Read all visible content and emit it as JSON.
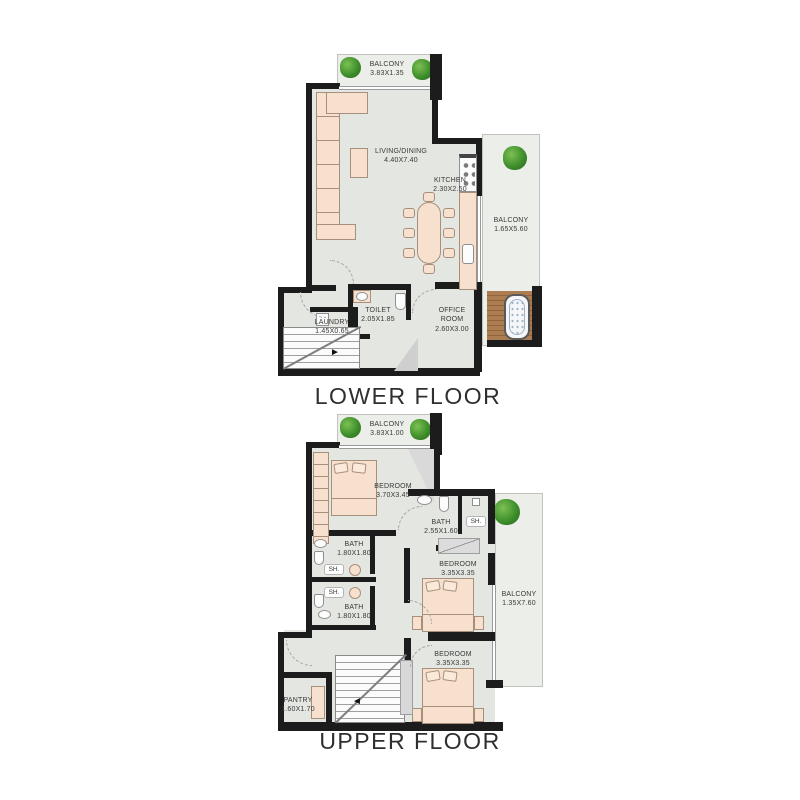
{
  "page": {
    "background": "#ffffff"
  },
  "colors": {
    "wall": "#1c1c1c",
    "floor": "#e4e6e1",
    "balcony_floor": "#eceee9",
    "furniture": "#f7e0cd",
    "wood_deck": "#ab7d50",
    "plant": "#3f8f2c"
  },
  "floors": [
    {
      "title": "LOWER FLOOR",
      "rooms": {
        "balcony_top": {
          "name": "BALCONY",
          "dims": "3.83X1.35"
        },
        "living": {
          "name": "LIVING/DINING",
          "dims": "4.40X7.40"
        },
        "kitchen": {
          "name": "KITCHEN",
          "dims": "2.30X2.50"
        },
        "balcony_right": {
          "name": "BALCONY",
          "dims": "1.65X5.60"
        },
        "toilet": {
          "name": "TOILET",
          "dims": "2.05X1.85"
        },
        "laundry": {
          "name": "LAUNDRY",
          "dims": "1.45X0.65"
        },
        "office": {
          "name": "OFFICE ROOM",
          "dims": "2.60X3.00"
        }
      }
    },
    {
      "title": "UPPER FLOOR",
      "rooms": {
        "balcony_top": {
          "name": "BALCONY",
          "dims": "3.83X1.00"
        },
        "bedroom1": {
          "name": "BEDROOM",
          "dims": "3.70X3.45"
        },
        "bath_mid": {
          "name": "BATH",
          "dims": "2.55X1.60"
        },
        "shower_mid": {
          "name": "SH."
        },
        "bath_a": {
          "name": "BATH",
          "dims": "1.80X1.80"
        },
        "shower_a": {
          "name": "SH."
        },
        "shower_b": {
          "name": "SH."
        },
        "bath_b": {
          "name": "BATH",
          "dims": "1.80X1.80"
        },
        "bedroom2": {
          "name": "BEDROOM",
          "dims": "3.35X3.35"
        },
        "balcony_right": {
          "name": "BALCONY",
          "dims": "1.35X7.60"
        },
        "bedroom3": {
          "name": "BEDROOM",
          "dims": "3.35X3.35"
        },
        "pantry": {
          "name": "PANTRY",
          "dims": "1.60X1.70"
        }
      }
    }
  ]
}
